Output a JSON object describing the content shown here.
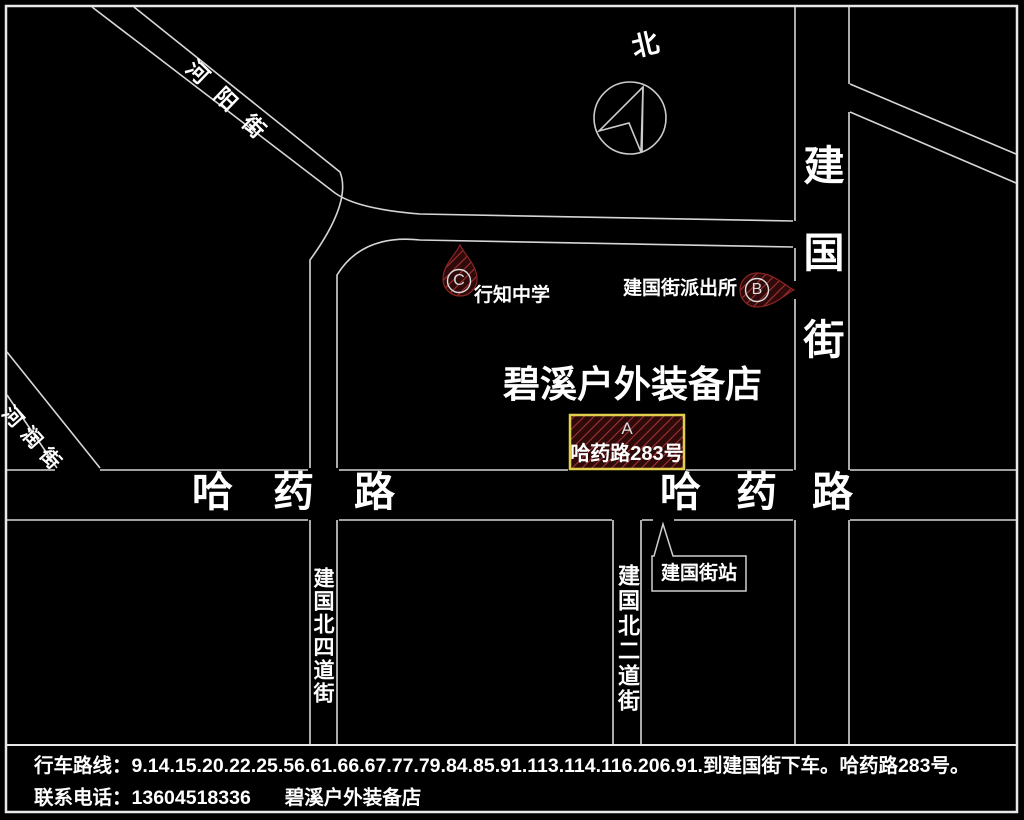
{
  "map": {
    "compass": {
      "label": "北"
    },
    "streets": {
      "heyang": "河阳街",
      "herun": "河润街",
      "jianguo_vertical": "建国街",
      "hayao_left": "哈药路",
      "hayao_right": "哈药路",
      "jianguo_north_4th": "建国北四道街",
      "jianguo_north_2nd": "建国北二道街"
    },
    "store_name": "碧溪户外装备店",
    "bus_stop_label": "建国街站",
    "markers": {
      "a": {
        "letter": "A",
        "label": "哈药路283号"
      },
      "b": {
        "letter": "B",
        "label": "建国街派出所"
      },
      "c": {
        "letter": "C",
        "label": "行知中学"
      }
    }
  },
  "footer": {
    "route_line": "行车路线：9.14.15.20.22.25.56.61.66.67.77.79.84.85.91.113.114.116.206.91.到建国街下车。哈药路283号。",
    "contact_line": "联系电话：13604518336",
    "contact_store": "碧溪户外装备店"
  },
  "colors": {
    "background": "#000000",
    "road_line": "#d6d6d6",
    "text": "#ffffff",
    "marker_fill": "#2e0a0a",
    "marker_hatch": "#a03232",
    "marker_a_border": "#e2cf4e"
  }
}
